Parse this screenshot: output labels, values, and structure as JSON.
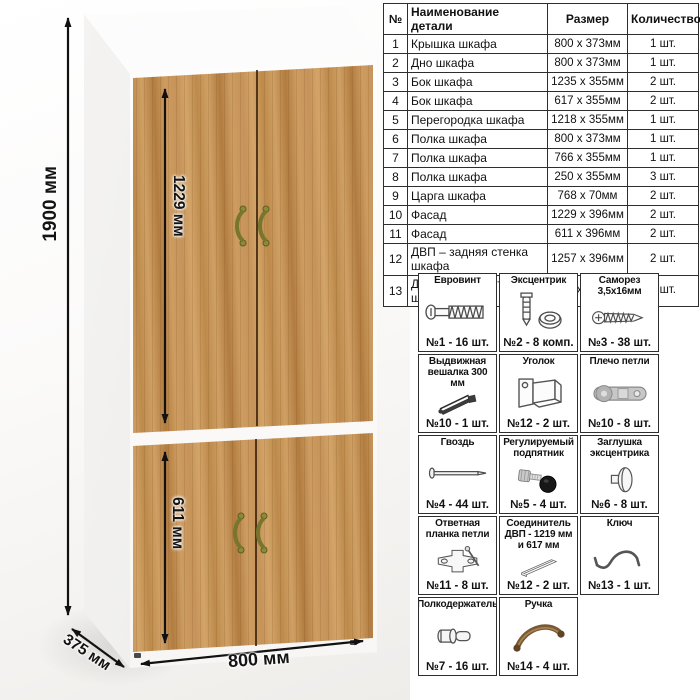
{
  "product_view": {
    "dimensions": {
      "height": "1900 мм",
      "upper_facade_height": "1229 мм",
      "lower_facade_height": "611 мм",
      "width": "800 мм",
      "depth": "375 мм"
    }
  },
  "parts_table": {
    "headers": [
      "№",
      "Наименование детали",
      "Размер",
      "Количество"
    ],
    "rows": [
      [
        "1",
        "Крышка шкафа",
        "800 х 373мм",
        "1 шт."
      ],
      [
        "2",
        "Дно шкафа",
        "800 х 373мм",
        "1 шт."
      ],
      [
        "3",
        "Бок шкафа",
        "1235 х 355мм",
        "2 шт."
      ],
      [
        "4",
        "Бок шкафа",
        "617 х 355мм",
        "2 шт."
      ],
      [
        "5",
        "Перегородка шкафа",
        "1218 х 355мм",
        "1 шт."
      ],
      [
        "6",
        "Полка шкафа",
        "800 х 373мм",
        "1 шт."
      ],
      [
        "7",
        "Полка шкафа",
        "766 х 355мм",
        "1 шт."
      ],
      [
        "8",
        "Полка шкафа",
        "250 х 355мм",
        "3 шт."
      ],
      [
        "9",
        "Царга шкафа",
        "768 х 70мм",
        "2 шт."
      ],
      [
        "10",
        "Фасад",
        "1229 х 396мм",
        "2 шт."
      ],
      [
        "11",
        "Фасад",
        "611 х 396мм",
        "2 шт."
      ],
      [
        "12",
        "ДВП – задняя стенка шкафа",
        "1257 х 396мм",
        "2 шт."
      ],
      [
        "13",
        "ДВП – задняя стенка шкафа",
        "639 х 396мм",
        "2 шт."
      ]
    ]
  },
  "hardware": {
    "items": [
      {
        "title": "Евровинт",
        "count": "№1 - 16 шт.",
        "icon": "euro-screw"
      },
      {
        "title": "Эксцентрик",
        "count": "№2 - 8 комп.",
        "icon": "cam-lock"
      },
      {
        "title": "Саморез 3,5х16мм",
        "count": "№3 - 38 шт.",
        "icon": "self-tapping-screw"
      },
      {
        "title": "Выдвижная вешалка 300 мм",
        "count": "№10 - 1 шт.",
        "icon": "pull-out-hanger"
      },
      {
        "title": "Уголок",
        "count": "№12 - 2 шт.",
        "icon": "corner-bracket"
      },
      {
        "title": "Плечо петли",
        "count": "№10 - 8 шт.",
        "icon": "hinge-arm"
      },
      {
        "title": "Гвоздь",
        "count": "№4 - 44 шт.",
        "icon": "nail"
      },
      {
        "title": "Регулируемый подпятник",
        "count": "№5 - 4 шт.",
        "icon": "adjustable-foot"
      },
      {
        "title": "Заглушка эксцентрика",
        "count": "№6 - 8 шт.",
        "icon": "cam-cap"
      },
      {
        "title": "Ответная планка петли",
        "count": "№11 - 8 шт.",
        "icon": "hinge-plate"
      },
      {
        "title": "Соединитель ДВП - 1219 мм и 617 мм",
        "count": "№12 - 2 шт.",
        "icon": "hdf-connector"
      },
      {
        "title": "Ключ",
        "count": "№13 - 1 шт.",
        "icon": "hex-key"
      },
      {
        "title": "Полкодержатель",
        "count": "№7 - 16 шт.",
        "icon": "shelf-pin"
      },
      {
        "title": "Ручка",
        "count": "№14 - 4 шт.",
        "icon": "door-handle"
      }
    ]
  },
  "colors": {
    "wood": "#c9975c",
    "handle": "#8b8a3a",
    "table_border": "#2e2e2e",
    "arrow": "#111111"
  }
}
